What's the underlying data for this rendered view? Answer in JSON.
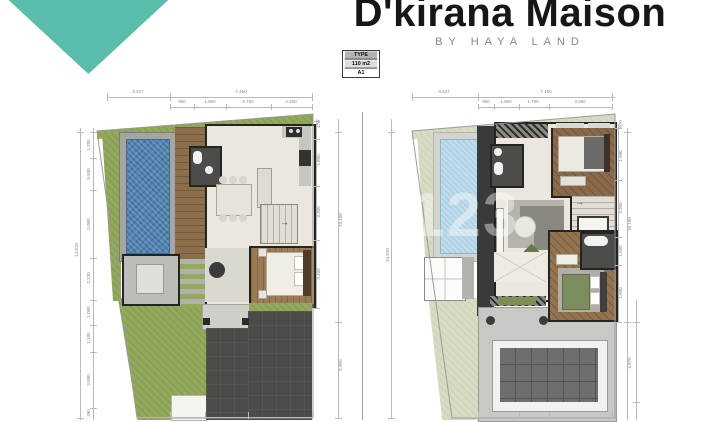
{
  "brand": {
    "title": "D'kirana Maison",
    "subtitle": "BY HAYA LAND",
    "accent_color": "#5abdab"
  },
  "badge": {
    "row1": "TYPE",
    "row2": "110 m2",
    "row3": "A1"
  },
  "watermark": "123",
  "palette": {
    "grass": "#93aa5b",
    "grass_faded": "#d6ddc3",
    "pool": "#4d80ae",
    "pool_faded": "#aed2e4",
    "wood": "#8c6e4b",
    "floor": "#ebe7de",
    "driveway": "#4b4b49",
    "wall": "#242422"
  },
  "dims": {
    "left": {
      "top_main": [
        "3.417",
        "7.450"
      ],
      "top_sub": [
        "950",
        "1.500",
        "2.750",
        "2.250"
      ],
      "side_left": [
        "1.700",
        "5.500",
        "3.000",
        "2.220",
        "1.000",
        "1.100",
        "3.800",
        "390"
      ],
      "side_left_total": "14.810",
      "side_right": [
        "470",
        "1.600",
        "3.300",
        "3.400"
      ],
      "side_right_total": "10.100",
      "side_right_lower": "5.850"
    },
    "right": {
      "top_main": [
        "3.437",
        "7.450"
      ],
      "top_sub": [
        "950",
        "1.500",
        "1.750",
        "3.250"
      ],
      "side_left_total": "14.810",
      "side_right": [
        "670",
        "1.600",
        "3.300",
        "1.500",
        "1.600"
      ],
      "side_right_total": "10.100",
      "side_right_lower": "4.870"
    }
  },
  "stair_arrow": "→"
}
